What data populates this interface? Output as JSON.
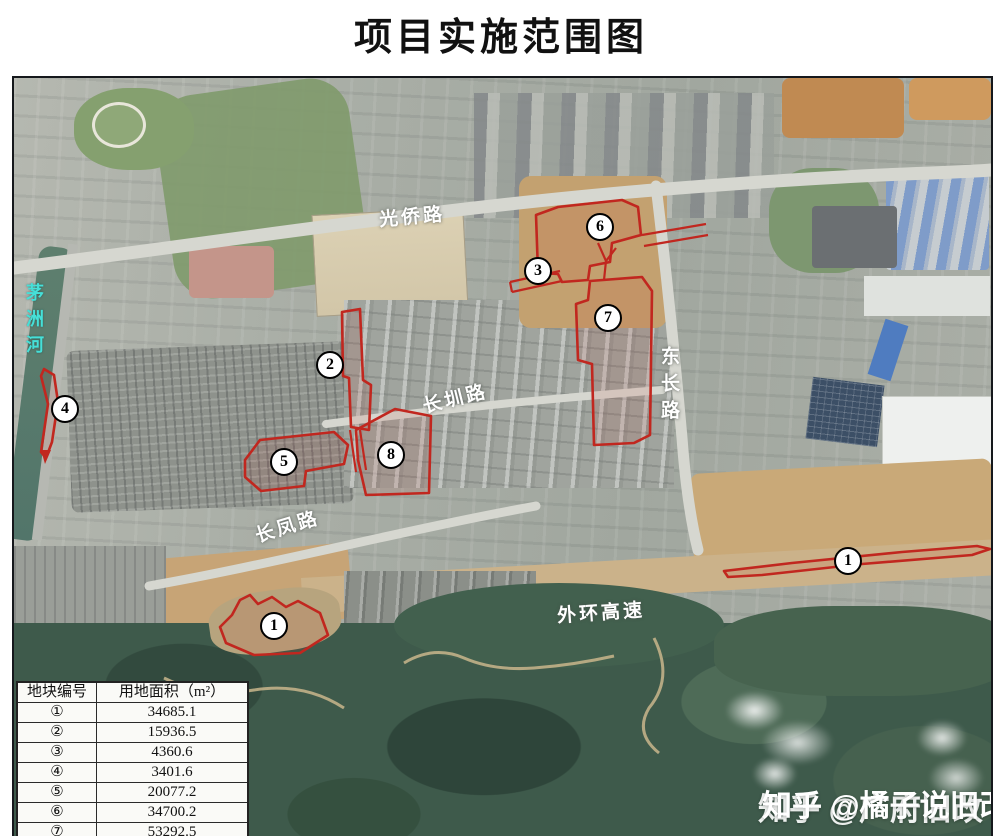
{
  "page": {
    "title": "项目实施范围图"
  },
  "colors": {
    "boundary_red": "#c1271f",
    "road_label_white": "#ffffff",
    "river_label_cyan": "#45e0d8"
  },
  "map": {
    "road_labels": {
      "guangqiao": "光侨路",
      "changzhen": "长圳路",
      "dongchang": "东长路",
      "changfeng": "长凤路",
      "waihuan_expressway": "外环高速",
      "river": "茅洲河"
    },
    "plot_markers": [
      {
        "id": "plot-6",
        "label": "6"
      },
      {
        "id": "plot-3",
        "label": "3"
      },
      {
        "id": "plot-7",
        "label": "7"
      },
      {
        "id": "plot-2",
        "label": "2"
      },
      {
        "id": "plot-4",
        "label": "4"
      },
      {
        "id": "plot-5",
        "label": "5"
      },
      {
        "id": "plot-8",
        "label": "8"
      },
      {
        "id": "plot-1-east",
        "label": "1"
      },
      {
        "id": "plot-1-south",
        "label": "1"
      }
    ]
  },
  "area_table": {
    "headers": [
      "地块编号",
      "用地面积（m²）"
    ],
    "rows": [
      {
        "no": "①",
        "area": "34685.1"
      },
      {
        "no": "②",
        "area": "15936.5"
      },
      {
        "no": "③",
        "area": "4360.6"
      },
      {
        "no": "④",
        "area": "3401.6"
      },
      {
        "no": "⑤",
        "area": "20077.2"
      },
      {
        "no": "⑥",
        "area": "34700.2"
      },
      {
        "no": "⑦",
        "area": "53292.5"
      }
    ]
  },
  "watermark": {
    "zhihu_back": "知乎 @广府旧改",
    "zhihu_front": "知乎 @橘子说旧改"
  }
}
